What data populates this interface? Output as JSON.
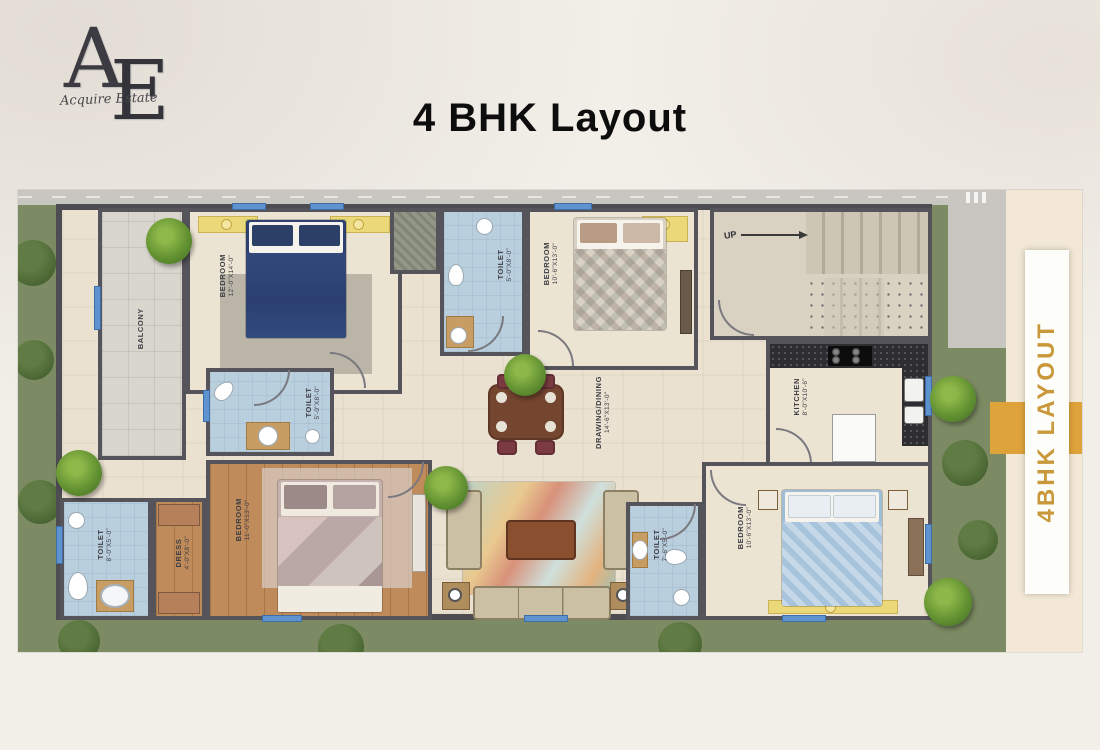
{
  "page": {
    "title": "4 BHK Layout"
  },
  "logo": {
    "letter_a": "A",
    "letter_e": "E",
    "script": "Acquire Estate"
  },
  "side_banner": {
    "text": "4BHK LAYOUT"
  },
  "plan": {
    "stair": {
      "label": "UP"
    },
    "rooms": {
      "balcony": {
        "label": "BALCONY",
        "dim": ""
      },
      "bedroom1": {
        "label": "BEDROOM",
        "dim": "12'-0\"X14'-0\""
      },
      "toilet1": {
        "label": "TOILET",
        "dim": "5'-0\"X8'-0\""
      },
      "bedroom2": {
        "label": "BEDROOM",
        "dim": "10'-6\"X13'-0\""
      },
      "kitchen": {
        "label": "KITCHEN",
        "dim": "8'-0\"X10'-6\""
      },
      "drawing": {
        "label": "DRAWING/DINING",
        "dim": "14'-6\"X13'-0\""
      },
      "toilet2": {
        "label": "TOILET",
        "dim": "5'-0\"X8'-0\""
      },
      "bedroom3": {
        "label": "BEDROOM",
        "dim": "11'-0\"X13'-0\""
      },
      "toilet3": {
        "label": "TOILET",
        "dim": "8'-0\"X5'-0\""
      },
      "dress": {
        "label": "DRESS",
        "dim": "4'-0\"X8'-0\""
      },
      "toilet4": {
        "label": "TOILET",
        "dim": "7'-6\"X5'-0\""
      },
      "bedroom4": {
        "label": "BEDROOM",
        "dim": "10'-6\"X13'-0\""
      }
    },
    "colors": {
      "accent_gold": "#DFA33C",
      "wall": "#55545A",
      "toilet_floor": "#B9CFDE",
      "floor": "#ECE4D2",
      "greenery": "#7C8B63"
    }
  }
}
